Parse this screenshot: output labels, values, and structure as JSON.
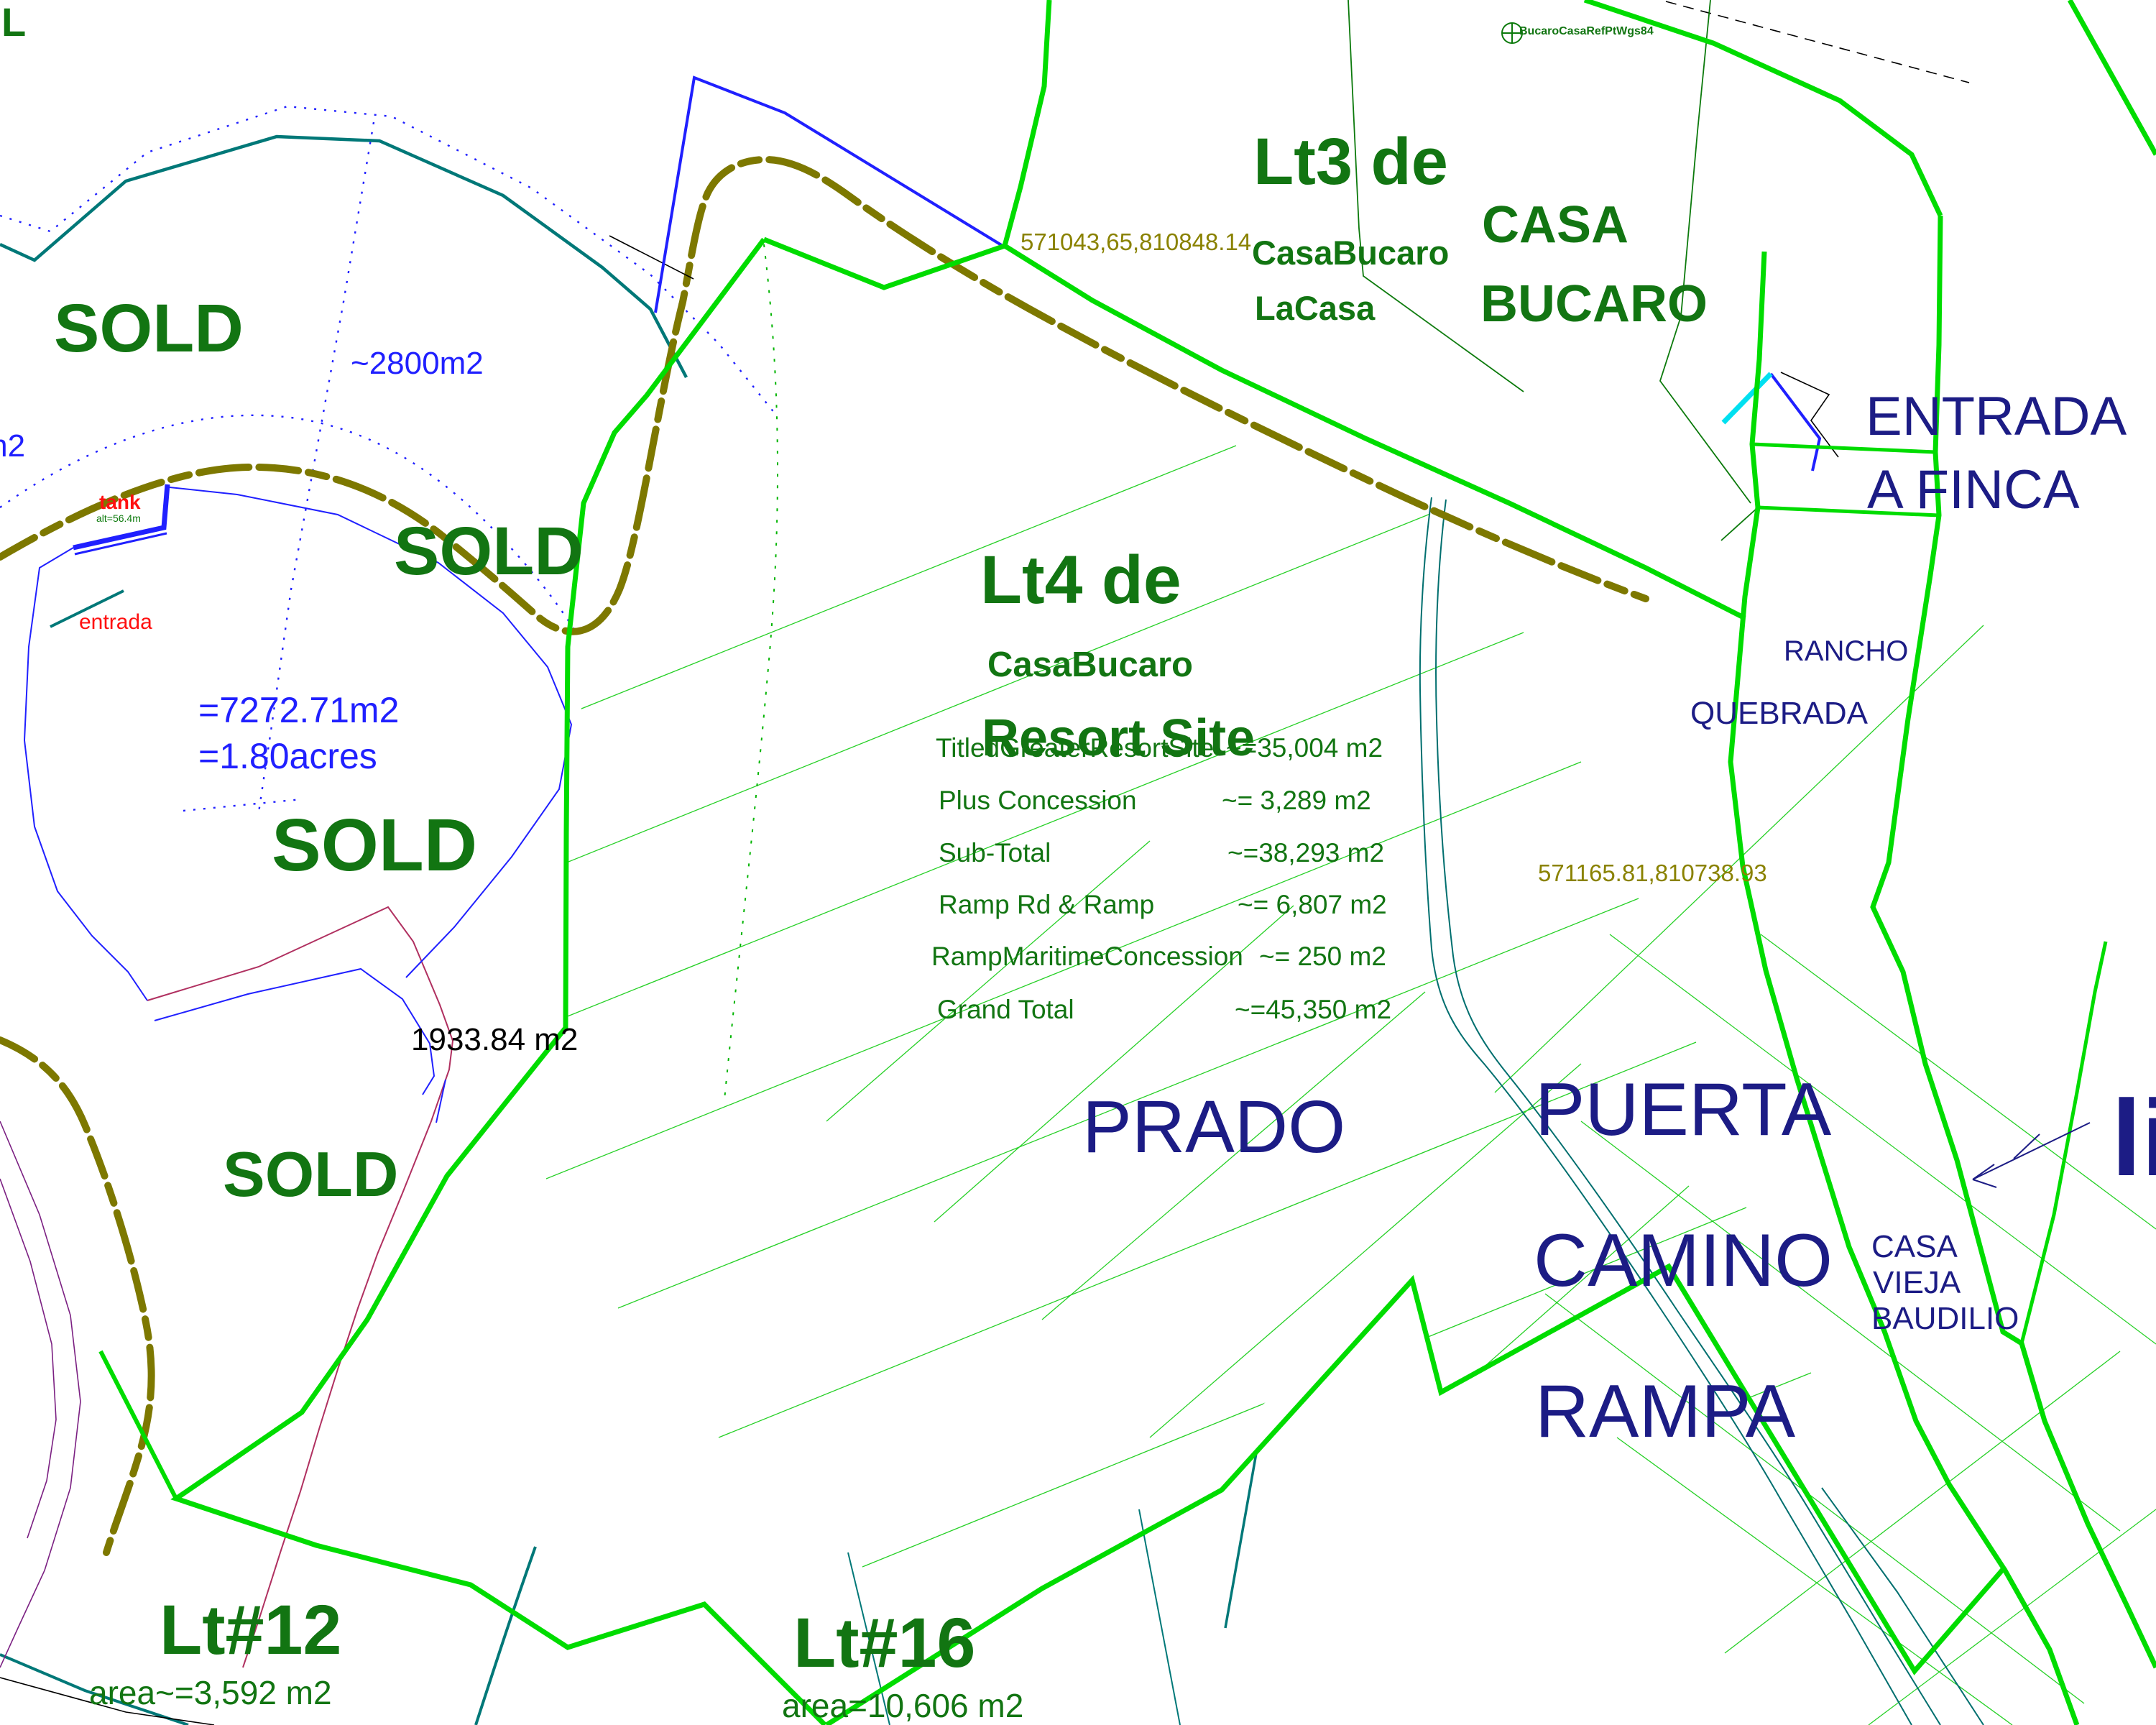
{
  "colors": {
    "boundary_green": "#00dc00",
    "hatch_green": "#00c800",
    "label_dark_green": "#127512",
    "road_olive": "#7d7800",
    "coord_olive": "#8a8200",
    "navy": "#1c1c85",
    "blue": "#2020ff",
    "teal": "#007878",
    "red": "#ff1010",
    "crimson": "#b03060",
    "purple": "#7b2082",
    "cyan": "#00e0f0",
    "black": "#000000"
  },
  "labels": {
    "corner_partial": "L",
    "sold": "SOLD",
    "area_2800": "~2800m2",
    "m2_partial": "m2",
    "tank": "tank",
    "tank_alt": "alt=56.4m",
    "entrada": "entrada",
    "area_7272": "=7272.71m2",
    "area_acres": "=1.80acres",
    "area_1933": "1933.84 m2"
  },
  "lt3": {
    "title": "Lt3 de",
    "line2": "CasaBucaro",
    "line3": "LaCasa"
  },
  "casa_bucaro": {
    "line1": "CASA",
    "line2": "BUCARO"
  },
  "ref_point": "BucaroCasaRefPtWgs84",
  "coords": {
    "c1": "571043,65,810848.14",
    "c2": "571165.81,810738.93"
  },
  "entrada_finca": {
    "line1": "ENTRADA",
    "line2": "A FINCA"
  },
  "lt4": {
    "title": "Lt4 de",
    "line2": "CasaBucaro",
    "line3": "Resort Site"
  },
  "area_table": {
    "rows": [
      {
        "label": "TitledGreaterResortSite",
        "value": "~=35,004 m2"
      },
      {
        "label": "Plus Concession",
        "value": "~=  3,289 m2"
      },
      {
        "label": "Sub-Total",
        "value": "~=38,293 m2"
      },
      {
        "label": "Ramp Rd & Ramp",
        "value": "~= 6,807 m2"
      },
      {
        "label": "RampMaritimeConcession",
        "value": "~= 250 m2"
      },
      {
        "label": "Grand Total",
        "value": "~=45,350 m2"
      }
    ]
  },
  "places": {
    "rancho": "RANCHO",
    "quebrada": "QUEBRADA",
    "prado": "PRADO",
    "puerta": [
      "PUERTA",
      "CAMINO",
      "RAMPA"
    ],
    "casa_vieja": [
      "CASA",
      "VIEJA",
      "BAUDILIO"
    ],
    "li_partial": "li"
  },
  "lt12": {
    "title": "Lt#12",
    "area": "area~=3,592 m2"
  },
  "lt16": {
    "title": "Lt#16",
    "area": "area=10,606 m2"
  }
}
